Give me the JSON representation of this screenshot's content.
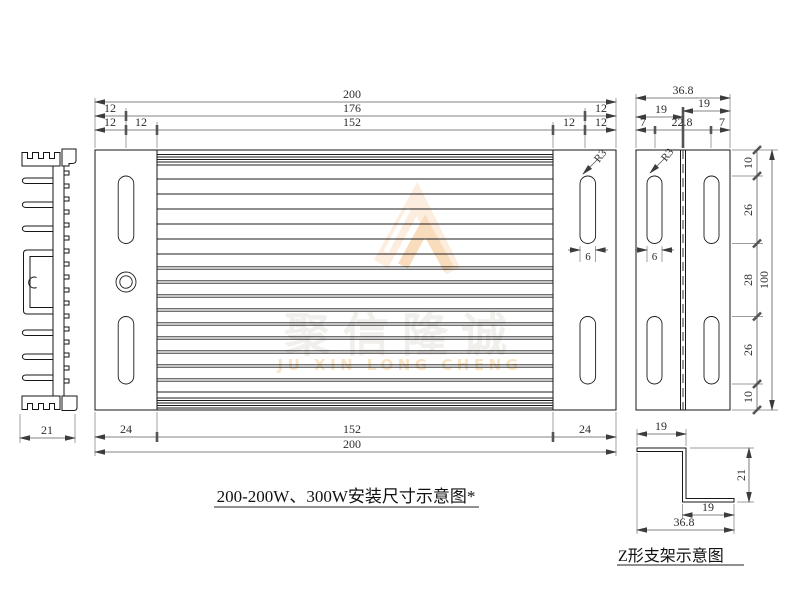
{
  "captions": {
    "main": "200-200W、300W安装尺寸示意图*",
    "z_bracket": "Z形支架示意图"
  },
  "watermark": {
    "cn": "聚信隆诚",
    "en": "JU XIN LONG CHENG"
  },
  "colors": {
    "watermark_cn": "#f1efec",
    "watermark_en": "#fae3c3",
    "logo_light": "#fcedde",
    "logo_dark": "#f8dcbb"
  },
  "heatsink_section": {
    "width": "21"
  },
  "top_view": {
    "top_dims": {
      "overall": "200",
      "mid": [
        "12",
        "176",
        "12"
      ],
      "inner": [
        "12",
        "12",
        "152",
        "12",
        "12"
      ]
    },
    "bottom_dims": {
      "inner": [
        "24",
        "152",
        "24"
      ],
      "overall": "200"
    },
    "slot_radius": "R3",
    "slot_width": "6"
  },
  "side_view": {
    "top_dims": {
      "overall": "36.8",
      "left_bracket": "19",
      "right_bracket": "19",
      "inner": [
        "7",
        "22.8",
        "7"
      ]
    },
    "right_dims": {
      "chain": [
        "10",
        "26",
        "28",
        "26",
        "10"
      ],
      "overall": "100"
    },
    "slot_radius": "R3",
    "slot_width": "6"
  },
  "z_bracket": {
    "top_flange": "19",
    "height": "21",
    "bottom_flange": "19",
    "overall": "36.8"
  }
}
